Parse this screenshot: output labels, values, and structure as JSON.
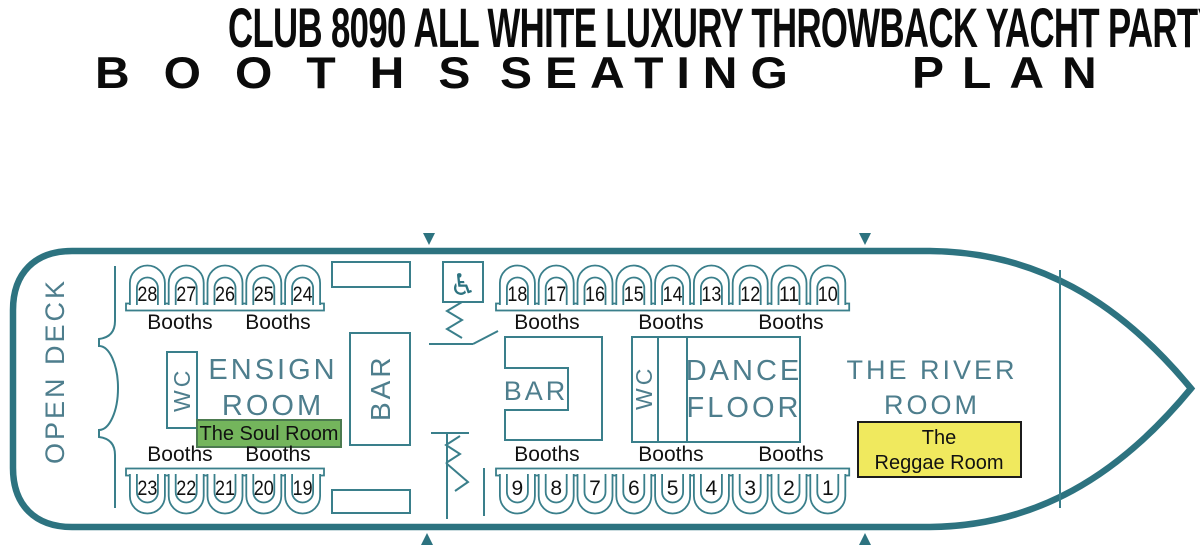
{
  "header": {
    "title": "CLUB 8090 ALL WHITE LUXURY THROWBACK YACHT PARTY",
    "subtitle_words": [
      "BOOTHS",
      "SEATING",
      "PLAN"
    ]
  },
  "plan": {
    "open_deck": "OPEN DECK",
    "wc_left": "WC",
    "ensign_room": {
      "line1": "ENSIGN",
      "line2": "ROOM"
    },
    "soul_room": "The Soul Room",
    "bar_left": "BAR",
    "bar_right": "BAR",
    "wc_right": "WC",
    "dance_floor": {
      "line1": "DANCE",
      "line2": "FLOOR"
    },
    "river_room": {
      "line1": "THE RIVER",
      "line2": "ROOM"
    },
    "reggae_room": {
      "line1": "The",
      "line2": "Reggae Room"
    },
    "wheelchair_icon": "♿"
  },
  "booths": {
    "top_left": {
      "numbers": [
        "28",
        "27",
        "26",
        "25",
        "24"
      ],
      "labels": [
        "Booths",
        "Booths"
      ]
    },
    "top_right": {
      "numbers": [
        "18",
        "17",
        "16",
        "15",
        "14",
        "13",
        "12",
        "11",
        "10"
      ],
      "labels": [
        "Booths",
        "Booths",
        "Booths"
      ]
    },
    "bottom_left": {
      "numbers": [
        "23",
        "22",
        "21",
        "20",
        "19"
      ],
      "labels": [
        "Booths",
        "Booths"
      ]
    },
    "bottom_right": {
      "numbers": [
        "9",
        "8",
        "7",
        "6",
        "5",
        "4",
        "3",
        "2",
        "1"
      ],
      "labels": [
        "Booths",
        "Booths",
        "Booths"
      ]
    }
  },
  "colors": {
    "hull": "#2d7380",
    "line": "#3a7f8b",
    "room_text": "#4e7e8d",
    "soul_fill": "#74b55c",
    "soul_border": "#4c7a4f",
    "reggae_fill": "#f0e95e",
    "reggae_border": "#1c1c1c",
    "text": "#111111"
  }
}
